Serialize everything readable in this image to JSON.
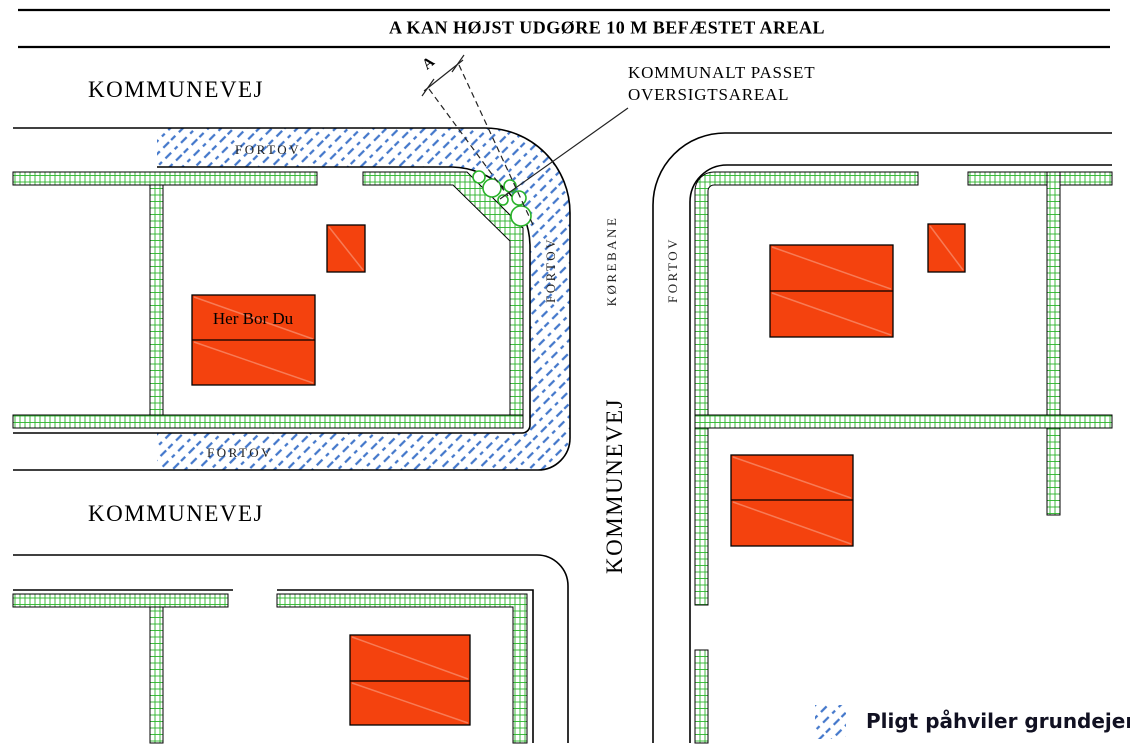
{
  "title": "A KAN HØJST UDGØRE 10 M BEFÆSTET AREAL",
  "roads": {
    "top_road": "KOMMUNEVEJ",
    "lower_road": "KOMMUNEVEJ",
    "vertical_road": "KOMMUNEVEJ",
    "carriageway": "KØREBANE"
  },
  "sidewalks": {
    "top": "FORTOV",
    "bottom": "FORTOV",
    "vertical_west": "FORTOV",
    "vertical_east": "FORTOV"
  },
  "annotations": {
    "corner_note_line1": "KOMMUNALT PASSET",
    "corner_note_line2": "OVERSIGTSAREAL",
    "dimension_label": "A",
    "house_label": "Her Bor Du"
  },
  "legend": {
    "hatch_label": "Pligt påhviler grundejer"
  },
  "colors": {
    "hatch_blue": "#4478CB",
    "hedge_green": "#2BB42B",
    "building_orange": "#F4420E",
    "ink": "#000000"
  }
}
